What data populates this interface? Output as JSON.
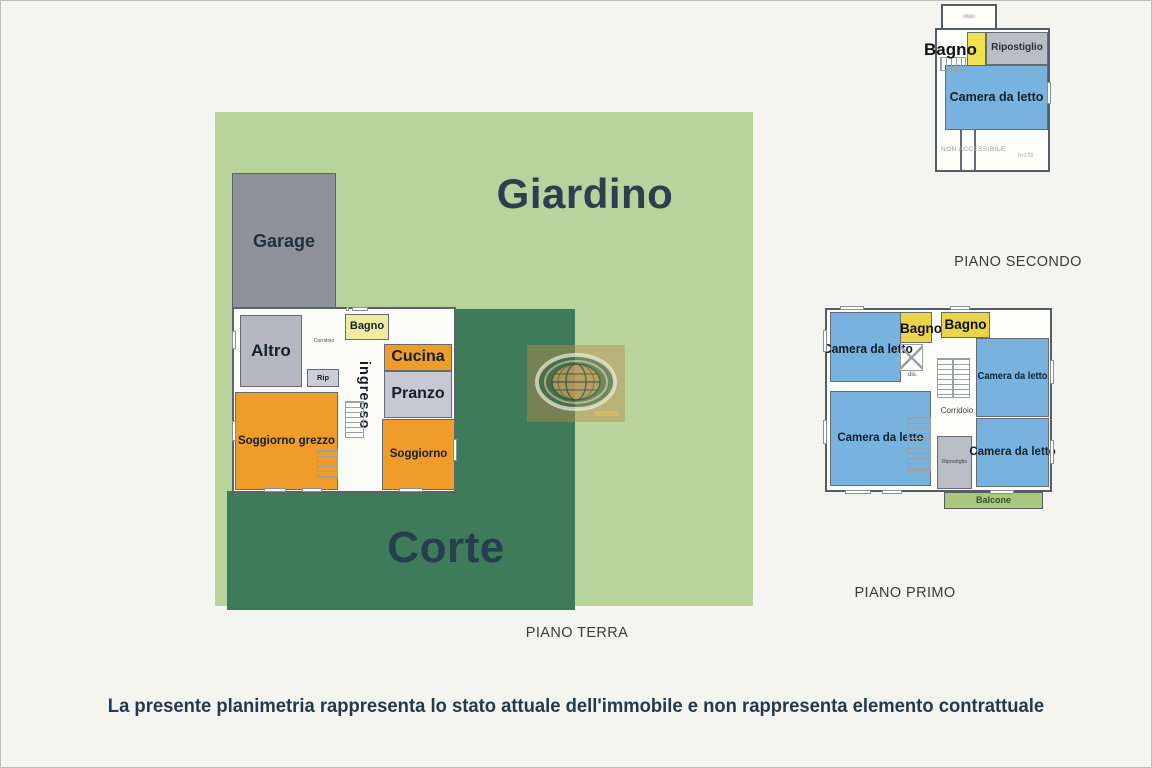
{
  "footer": {
    "disclaimer": "La presente planimetria rappresenta lo stato attuale dell'immobile e non rappresenta elemento contrattuale"
  },
  "floors": {
    "terra": {
      "caption": "PIANO TERRA",
      "giardino": "Giardino",
      "corte": "Corte",
      "garage": "Garage",
      "altro": "Altro",
      "corridoio": "Corridoio",
      "rip": "Rip",
      "bagno": "Bagno",
      "cucina": "Cucina",
      "pranzo": "Pranzo",
      "ingresso": "ingresso",
      "soggiorno": "Soggiorno",
      "soggiorno_grezzo": "Soggiorno grezzo"
    },
    "primo": {
      "caption": "PIANO PRIMO",
      "camera_tl": "Camera da letto",
      "camera_tr": "Camera da letto",
      "camera_bl": "Camera da letto",
      "camera_br": "Camera da letto",
      "bagno_1": "Bagno",
      "bagno_2": "Bagno",
      "dis": "dis.",
      "corridoio": "Corridoio",
      "ripostiglio": "Ripostiglio",
      "balcone": "Balcone"
    },
    "secondo": {
      "caption": "PIANO SECONDO",
      "top_box": "sfiato",
      "bagno": "Bagno",
      "ripostiglio": "Ripostiglio",
      "camera": "Camera da letto",
      "non_accessibile": "NON ACCESSIBILE",
      "height_note": "h<1.50"
    }
  },
  "colors": {
    "background": "#f4f4f1",
    "giardino_green": "#b8d39b",
    "corte_green": "#3e7b5a",
    "balcone_green": "#a9c77d",
    "bedroom_blue": "#78b3df",
    "bagno_yellow_pt": "#eeeb9e",
    "bagno_yellow_p1": "#e9d44c",
    "bagno_yellow_p2": "#eee24e",
    "orange_room": "#f09c2b",
    "gray_room": "#c6c9d1",
    "garage_gray": "#8e939b",
    "wall": "#666c75",
    "title_navy": "#2c3e50"
  }
}
